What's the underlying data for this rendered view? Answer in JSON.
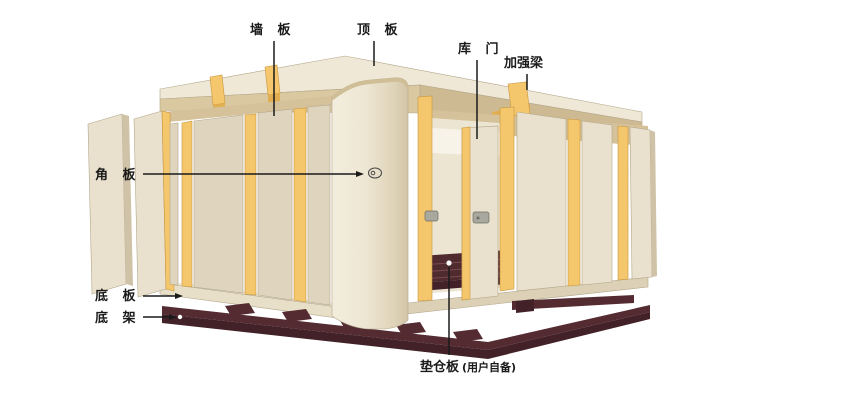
{
  "labels": {
    "wall_panel": {
      "text": "墙 板"
    },
    "top_panel": {
      "text": "顶 板"
    },
    "door": {
      "text": "库 门"
    },
    "reinforcement_beam": {
      "text": "加强梁"
    },
    "corner_panel": {
      "text": "角 板"
    },
    "bottom_panel": {
      "text": "底 板"
    },
    "bottom_frame": {
      "text": "底 架"
    },
    "pallet": {
      "text": "垫仓板"
    },
    "pallet_note": {
      "text": "(用户自备)"
    }
  },
  "colors": {
    "roof_top": "#EFE8D6",
    "roof_band": "#DAC8A1",
    "roof_band_dark": "#CDB992",
    "soffit": "#D5C19A",
    "panel_face": "#E9E1CD",
    "panel_face_left": "#DFD5BF",
    "panel_shade": "#CFC2A6",
    "joint_yellow": "#F4C76D",
    "joint_yellow_dark": "#E2AE52",
    "interior": "#F7F3E8",
    "interior_wall": "#ECE5D1",
    "slab_face": "#E8DFC8",
    "slab_side": "#DCD1B6",
    "frame_dark": "#542B31",
    "frame_darker": "#422228",
    "pallet_dark": "#4F2A2F",
    "handle": "#A9A89E",
    "marker": "#4A4A4A",
    "line": "#1A1A1A"
  }
}
